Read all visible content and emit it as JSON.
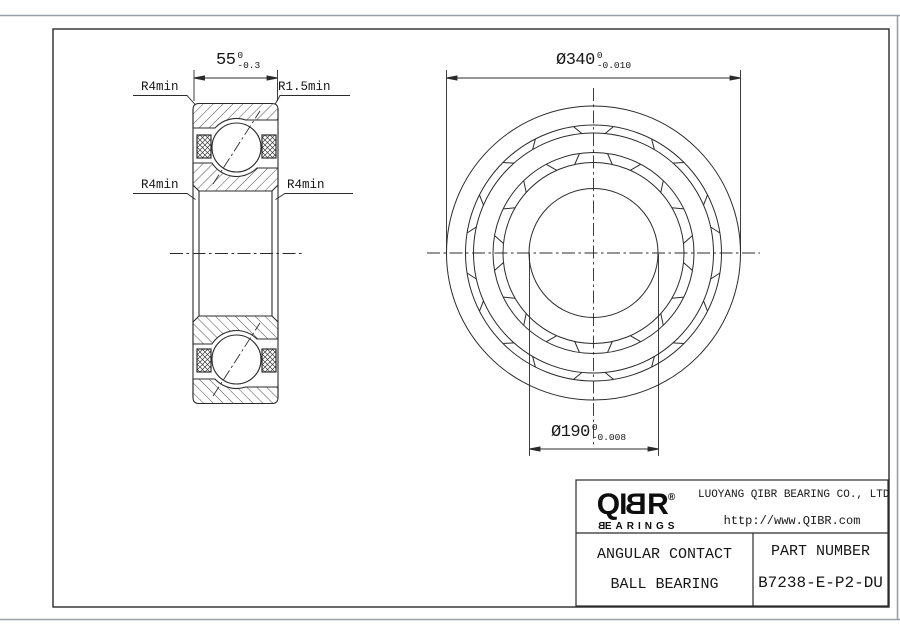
{
  "drawing": {
    "dim_width": {
      "value": "55",
      "tol_upper": "0",
      "tol_lower": "-0.3"
    },
    "dim_od": {
      "symbol": "Ø",
      "value": "340",
      "tol_upper": "0",
      "tol_lower": "-0.010"
    },
    "dim_bore": {
      "symbol": "Ø",
      "value": "190",
      "tol_upper": "0",
      "tol_lower": "-0.008"
    },
    "labels": {
      "fillet_top_left": "R4min",
      "fillet_top_right": "R1.5min",
      "fillet_mid_left": "R4min",
      "fillet_mid_right": "R4min"
    }
  },
  "title_block": {
    "logo": {
      "text": "QIBR",
      "part_before": "QI",
      "part_mirrored": "B",
      "part_after": "R",
      "registered": "®",
      "subtext": "BEARINGS",
      "sub_first_mirrored": "B",
      "sub_rest": "EARINGS"
    },
    "company": "LUOYANG QIBR BEARING CO., LTD",
    "website": "http://www.QIBR.com",
    "product_type_line1": "ANGULAR CONTACT",
    "product_type_line2": "BALL BEARING",
    "part_number_label": "PART NUMBER",
    "part_number": "B7238-E-P2-DU"
  }
}
